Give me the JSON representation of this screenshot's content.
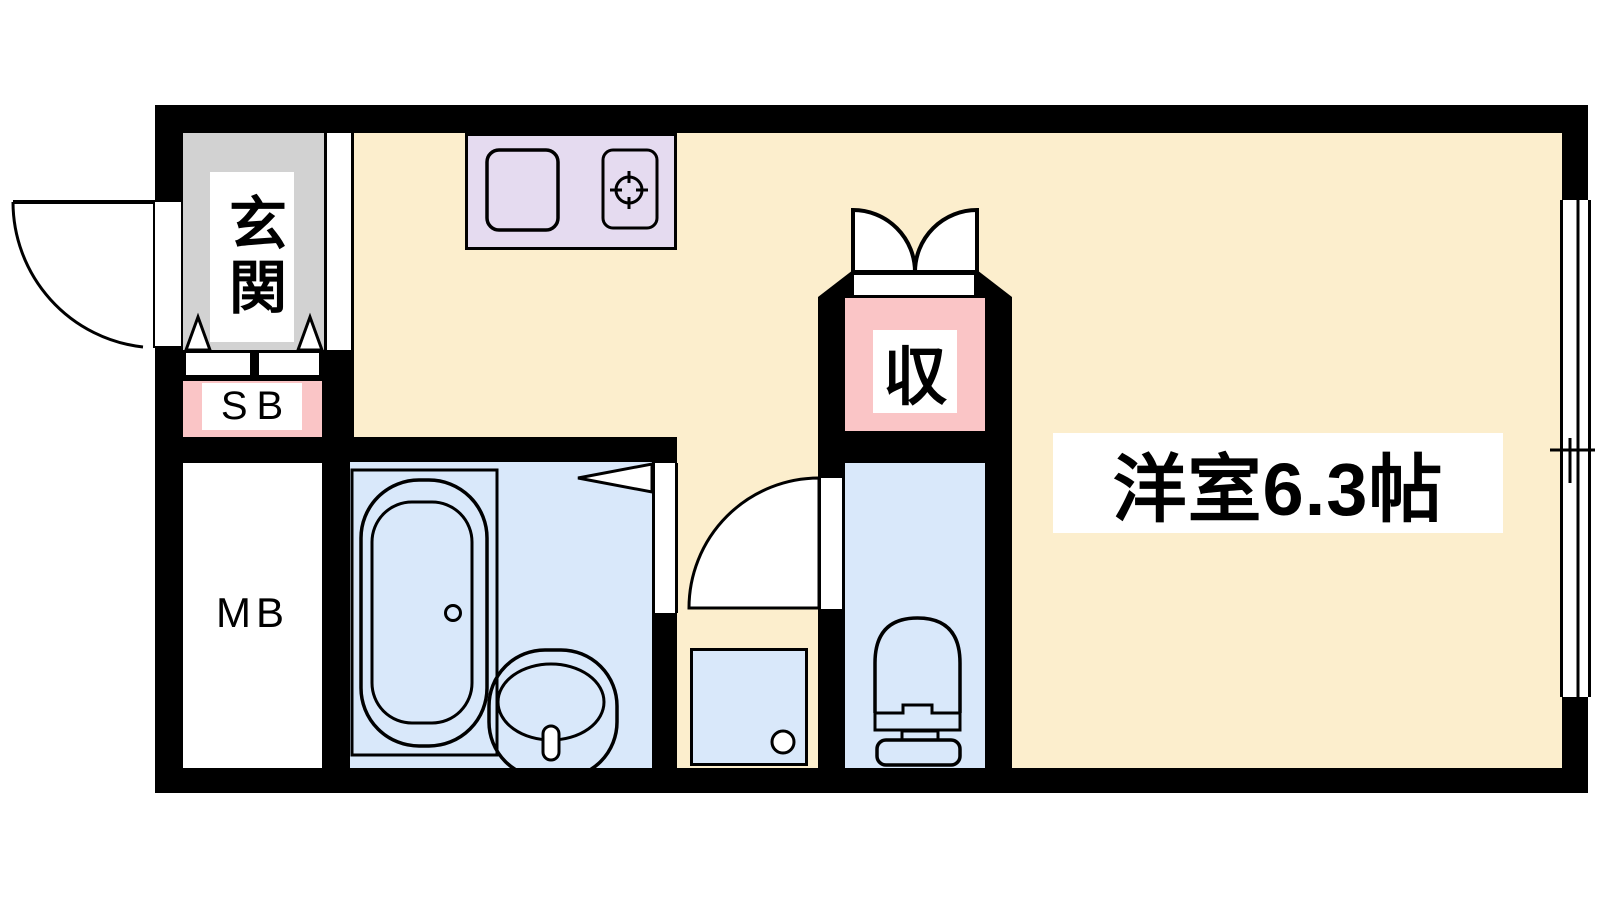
{
  "plan": {
    "type": "apartment-floor-plan",
    "rooms": {
      "entrance": {
        "label": "玄関"
      },
      "shoe_box": {
        "label": "SB"
      },
      "meter_box": {
        "label": "MB"
      },
      "closet": {
        "label": "収"
      },
      "western_room": {
        "label": "洋室6.3帖"
      }
    },
    "colors": {
      "wall": "#000000",
      "line": "#000000",
      "floor": "#FCEECD",
      "entrance_floor": "#D2D2D2",
      "wet_area_floor": "#D9E8FA",
      "kitchen_counter": "#E5DBF0",
      "storage_accent": "#FAC5C6",
      "label_background": "#FFFFFF"
    },
    "icons": {
      "entrance_door": "door-swing-arc",
      "entrance_step": "step-triangles",
      "closet_doors": "double-door-arcs",
      "kitchen": "sink-and-stove-burner",
      "bathroom": "bathtub-and-washbasin",
      "bathroom_door": "door-wedge",
      "hallway_door": "door-swing-arc",
      "laundry": "washing-machine-pan-with-drain",
      "toilet": "toilet-bowl-with-tank",
      "window": "sliding-window-double-line"
    }
  }
}
